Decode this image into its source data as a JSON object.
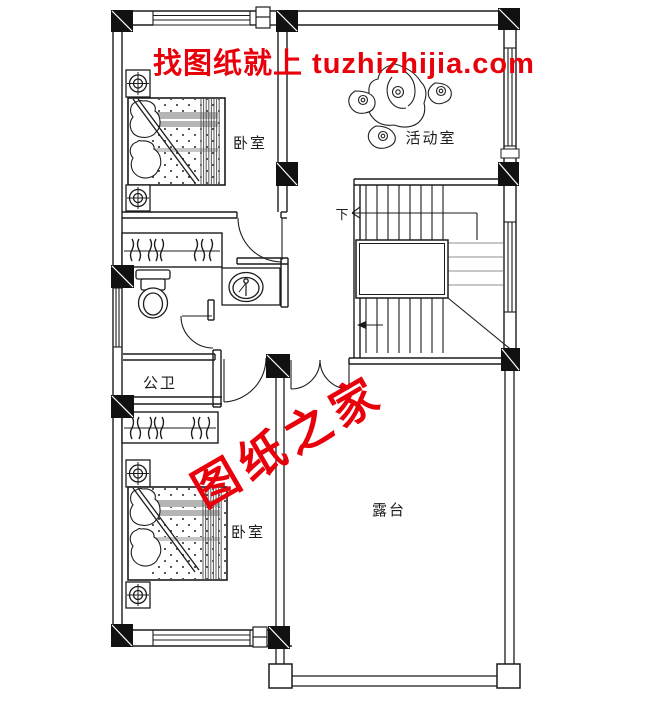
{
  "plan": {
    "title": "second-floor-plan",
    "rooms": {
      "bedroom_top": {
        "label": "卧室"
      },
      "activity": {
        "label": "活动室"
      },
      "bathroom": {
        "label": "公卫"
      },
      "bedroom_bottom": {
        "label": "卧室"
      },
      "terrace": {
        "label": "露台"
      }
    },
    "stairs": {
      "down_label": "下"
    },
    "watermark_top": {
      "text": "找图纸就上 tuzhizhijia.com",
      "color": "#e8000b"
    },
    "watermark_diagonal": {
      "text": "图纸之家",
      "color": "#e8000b"
    },
    "colors": {
      "line": "#1c1c1c",
      "stripe_gray": "#b5b5b5",
      "winder_gray": "#8f8f8f"
    }
  }
}
